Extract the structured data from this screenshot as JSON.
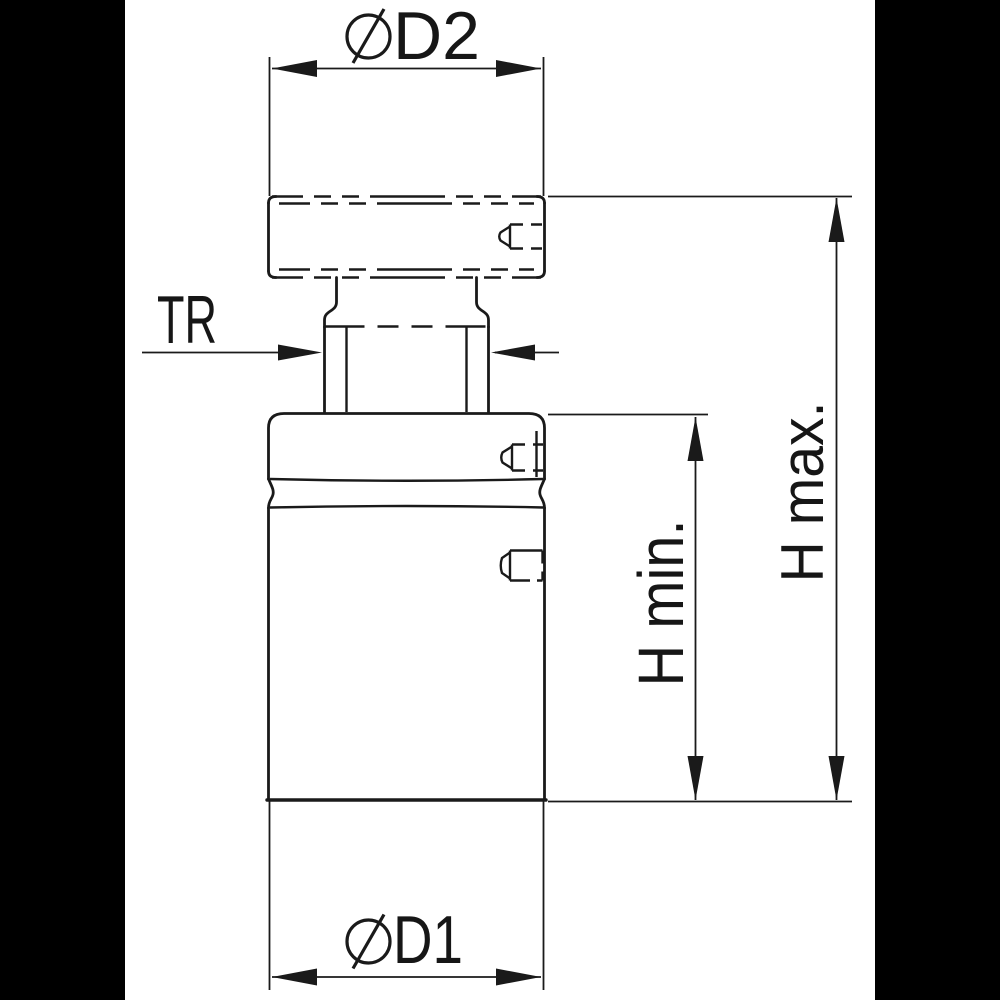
{
  "colors": {
    "background": "#ffffff",
    "letterbox": "#000000",
    "line": "#1a1a1a"
  },
  "labels": {
    "d2": {
      "symbol": "⌀",
      "text": "D2"
    },
    "tr": {
      "text": "TR"
    },
    "d1": {
      "symbol": "⌀",
      "text": "D1"
    },
    "h_min": {
      "text": "H min."
    },
    "h_max": {
      "text": "H max."
    }
  }
}
